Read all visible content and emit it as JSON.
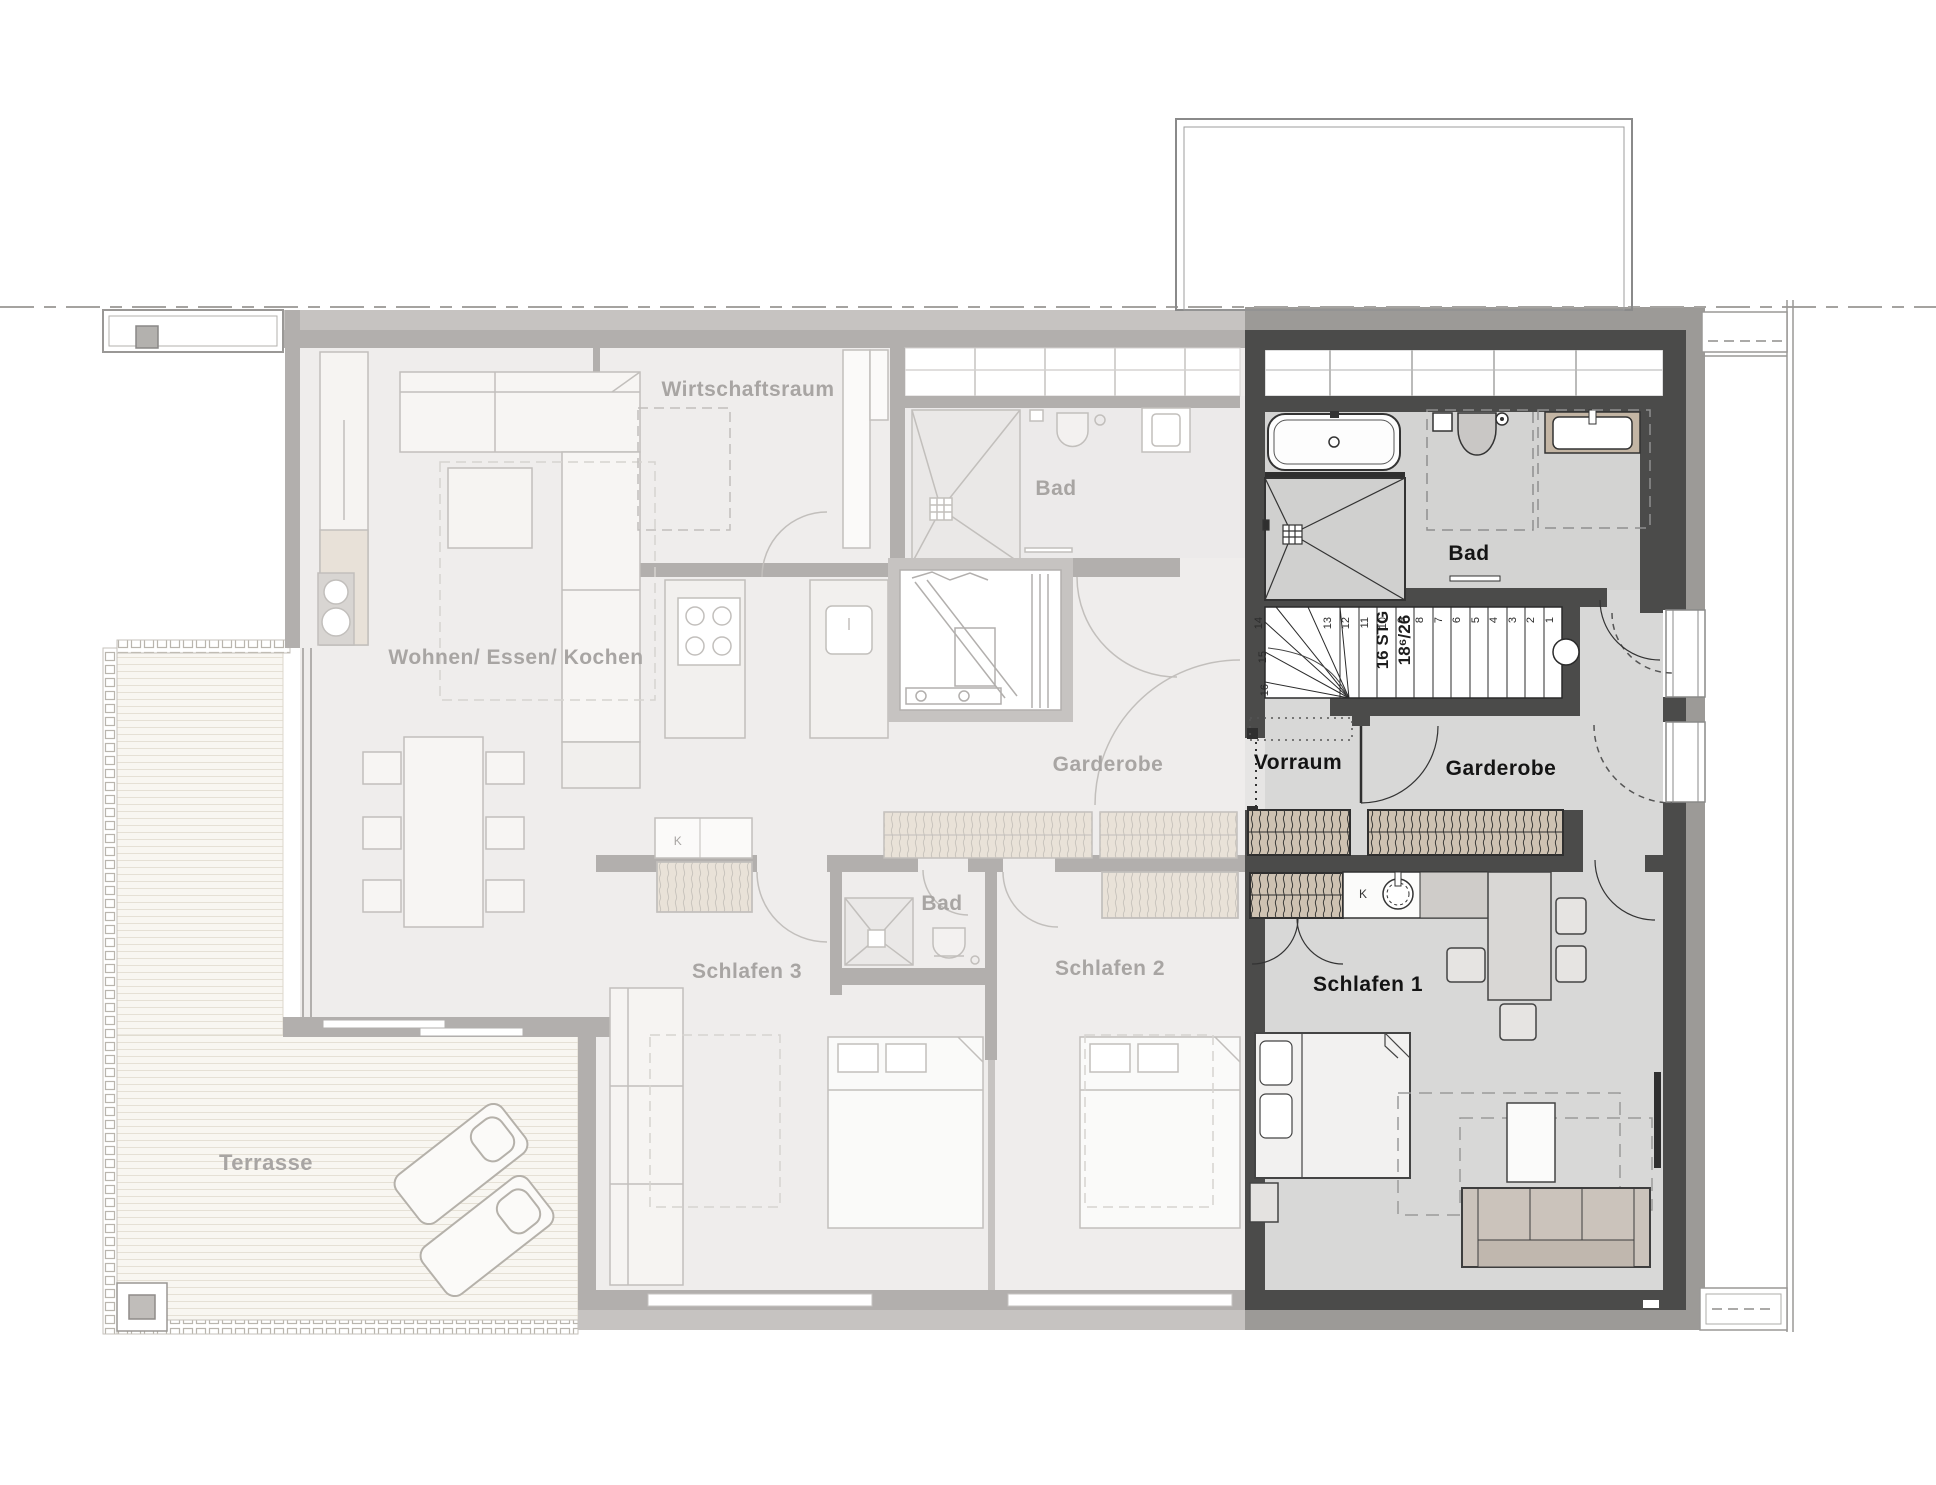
{
  "plan": {
    "faded_labels": {
      "wirtschaftsraum": "Wirtschaftsraum",
      "bad_top": "Bad",
      "wohnen_essen_kochen": "Wohnen/ Essen/ Kochen",
      "garderobe_corridor": "Garderobe",
      "schlafen_3": "Schlafen 3",
      "bad_small": "Bad",
      "schlafen_2": "Schlafen 2",
      "terrasse": "Terrasse",
      "k_closet": "K"
    },
    "unit_labels": {
      "bad": "Bad",
      "vorraum": "Vorraum",
      "garderobe": "Garderobe",
      "schlafen_1": "Schlafen 1",
      "k_closet": "K"
    },
    "stairs": {
      "annotation_line1": "16 STG",
      "annotation_line2": "18⁶/26",
      "steps": [
        "1",
        "2",
        "3",
        "4",
        "5",
        "6",
        "7",
        "8",
        "9",
        "10",
        "11",
        "12",
        "13",
        "14",
        "15",
        "16"
      ]
    },
    "colors": {
      "unit_wall": "#4b4b4a",
      "unit_floor": "#d8d8d7",
      "faded_wall": "#b2afad",
      "faded_floor": "#efedec",
      "wardrobe_tan": "#cec2b2",
      "outer_band": "#9c9a97",
      "deck": "#f8f6f1"
    }
  }
}
